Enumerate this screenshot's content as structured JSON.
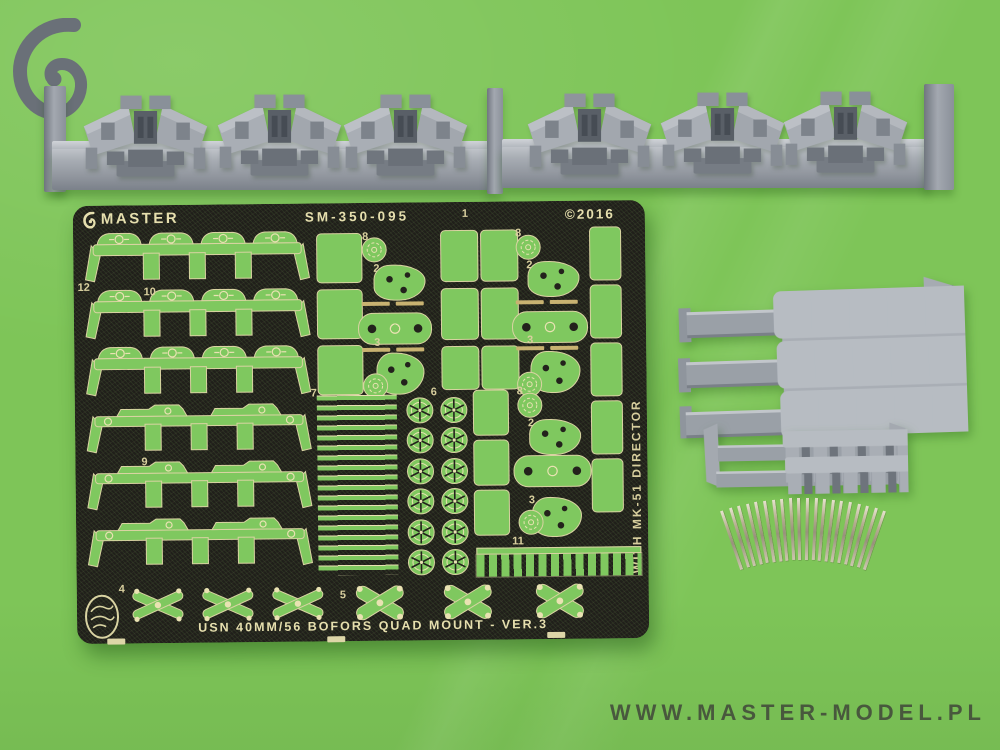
{
  "scene": {
    "background_color": "#7ec558",
    "watermark": "WWW.MASTER-MODEL.PL"
  },
  "fret": {
    "brand": "MASTER",
    "product_code": "SM-350-095",
    "copyright_text": "©2016",
    "side_text": "WITH MK-51 DIRECTOR",
    "bottom_title": "USN 40MM/56 BOFORS QUAD MOUNT - VER.3",
    "maker_badge": "North Star",
    "plate_color": "#201f1a",
    "part_color": "#7fc85f",
    "etch_text_color": "#e6dfae",
    "part_labels": [
      {
        "text": "12"
      },
      {
        "text": "10"
      },
      {
        "text": "9"
      },
      {
        "text": "8"
      },
      {
        "text": "2"
      },
      {
        "text": "3"
      },
      {
        "text": "7"
      },
      {
        "text": "6"
      },
      {
        "text": "1"
      },
      {
        "text": "8"
      },
      {
        "text": "2"
      },
      {
        "text": "3"
      },
      {
        "text": "8"
      },
      {
        "text": "2"
      },
      {
        "text": "3"
      },
      {
        "text": "11"
      },
      {
        "text": "4"
      },
      {
        "text": "5"
      }
    ]
  },
  "resin_parts": {
    "color": "#9aa1a9",
    "top_strips": {
      "strip_count": 2,
      "mounts_per_strip": 3
    },
    "large_rack": {
      "bar_count": 3,
      "studs_per_bar": 6
    },
    "small_rack": {
      "bar_count": 2,
      "studs_per_bar": 6
    }
  },
  "barrels": {
    "count": 20,
    "color": "#b5ae90"
  }
}
